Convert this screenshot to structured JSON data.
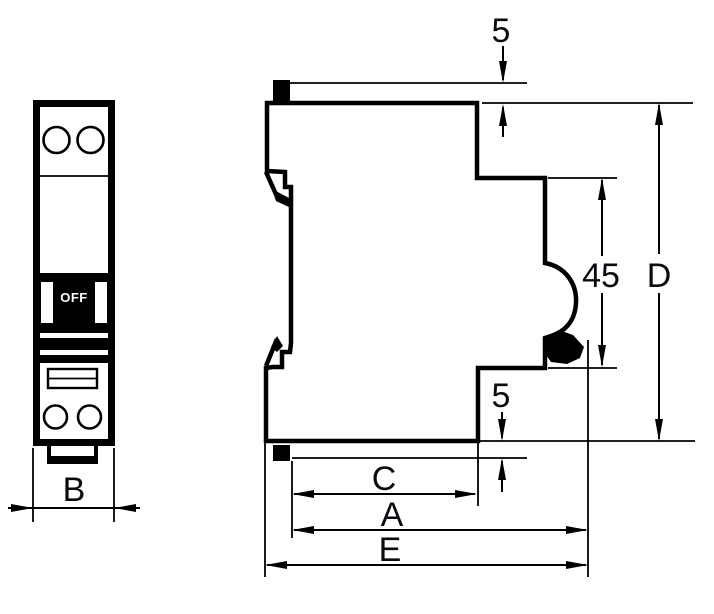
{
  "drawing": {
    "type": "circuit-breaker-dimensional-drawing",
    "views": [
      "front-view",
      "side-view"
    ]
  },
  "labels": {
    "switch_state": "OFF"
  },
  "dimensions": {
    "front_width": "B",
    "top_step": "5",
    "upper_section_height": "45",
    "overall_height": "D",
    "bottom_step": "5",
    "inner_depth": "C",
    "mid_depth": "A",
    "overall_depth": "E"
  },
  "colors": {
    "ink": "#000000",
    "paper": "#ffffff",
    "switch_text": "#ffffff"
  }
}
